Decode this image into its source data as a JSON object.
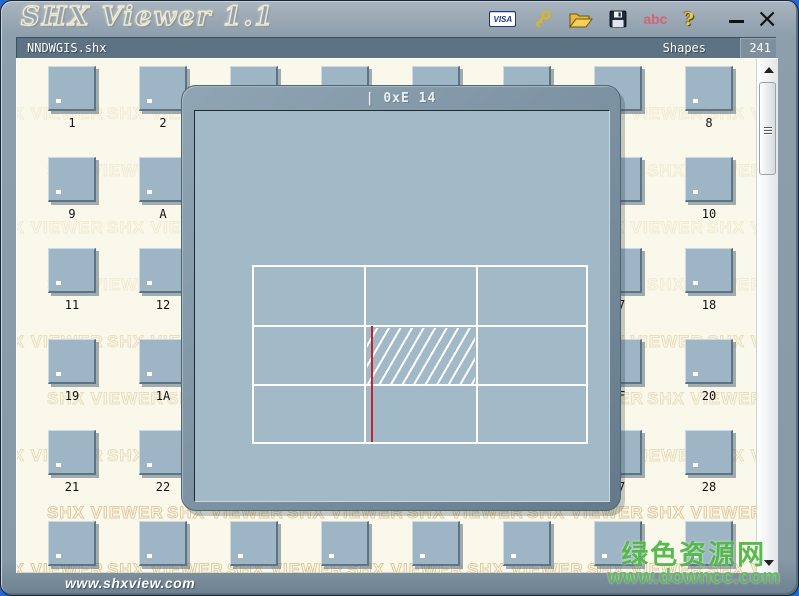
{
  "window": {
    "title": "SHX Viewer 1.1",
    "close_glyph": "×"
  },
  "toolbar": {
    "visa_label": "VISA",
    "abc_label": "abc",
    "help_glyph": "?"
  },
  "status_bar": {
    "filename": "NNDWGIS.shx",
    "shapes_label": "Shapes",
    "shape_count": "241"
  },
  "shape_grid": {
    "labels": [
      "1",
      "2",
      "3",
      "4",
      "5",
      "6",
      "7",
      "8",
      "9",
      "A",
      "B",
      "C",
      "D",
      "E",
      "F",
      "10",
      "11",
      "12",
      "13",
      "14",
      "15",
      "16",
      "17",
      "18",
      "19",
      "1A",
      "1B",
      "1C",
      "1D",
      "1E",
      "1F",
      "20",
      "21",
      "22",
      "23",
      "24",
      "25",
      "26",
      "27",
      "28",
      "29",
      "2A",
      "2B",
      "2C",
      "2D",
      "2E",
      "2F",
      "30"
    ]
  },
  "dialog": {
    "title": "| 0xE 14"
  },
  "watermark": {
    "text": "SHX VIEWER"
  },
  "footer": {
    "url": "www.shxview.com"
  },
  "site_watermark": {
    "title": "绿色资源网",
    "url": "www.downcc.com"
  },
  "colors": {
    "accent_red": "#c32430",
    "thumbnail": "#9db5c5",
    "desktop_blue": "#2667cf",
    "watermark_tan": "#dcc394",
    "site_green": "#46b43a"
  }
}
